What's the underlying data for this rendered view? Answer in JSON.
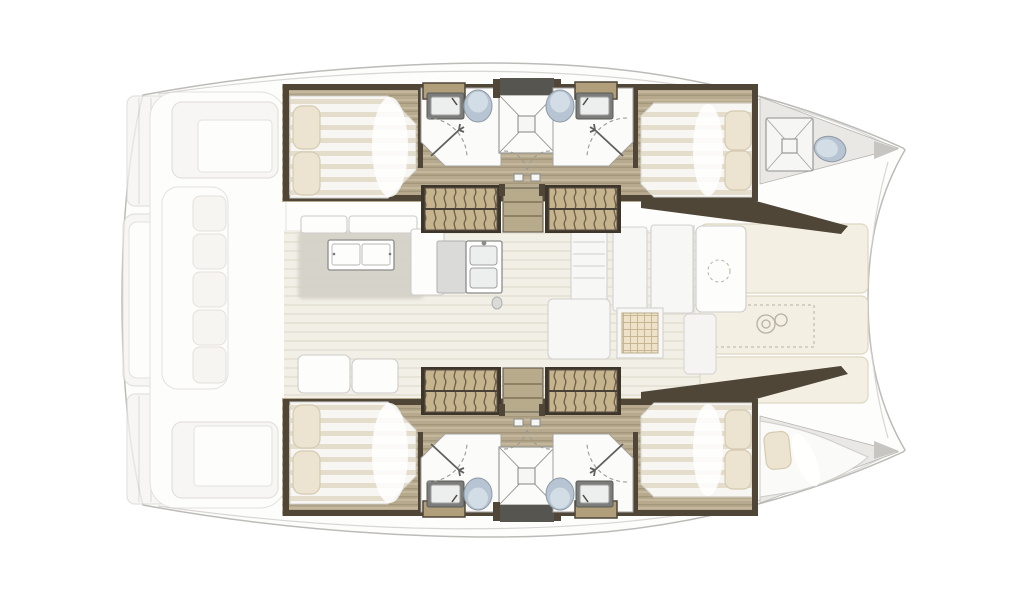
{
  "diagram": {
    "type": "floor-plan",
    "subject": "catamaran-yacht-interior-layout",
    "view": "top-down",
    "orientation": {
      "bow": "right",
      "stern": "left"
    },
    "areas": [
      "stern-swim-platforms",
      "aft-cockpit-with-bench-seating",
      "saloon-with-dining-table-and-galley-sink",
      "port-hull-top: aft-double-cabin, two-bathrooms, central-shower, forward-double-cabin",
      "starboard-hull-bottom: aft-double-cabin, two-bathrooms, central-shower, forward-double-cabin",
      "port-forepeak: storage-crate-and-sea-toilet",
      "starboard-forepeak: skipper-berth",
      "foredeck-sun-pads-with-windlass"
    ],
    "fixtures": [
      "double-berth-with-pillows",
      "washbasin",
      "toilet",
      "shower-enclosure",
      "shower-door-arc",
      "companionway-stairs",
      "stair-landing",
      "wardrobe",
      "deck-hatch",
      "dining-table",
      "saloon-bench",
      "galley-double-sink",
      "stove",
      "refrigerator-cabinet",
      "foredeck-door-with-porthole",
      "windlass",
      "anchor-locker-outline",
      "cockpit-bench-cushions",
      "transom-steps"
    ]
  },
  "palette": {
    "outline": "#bcbbb8",
    "deck_fill": "#fdfdfc",
    "deck_panel": "#f5f4f2",
    "deck_stroke": "#d9d8d5",
    "deck_line": "#d7d6d3",
    "wood_base": "#b6a98d",
    "wood_light": "#c4b79b",
    "wood_dark": "#a4977c",
    "wood_cabinet": "#b19f7c",
    "bulkhead": "#4f4638",
    "stair_frame": "#3e362b",
    "stair_base": "#c6b48f",
    "stair_wave": "#6f624b",
    "stair_mid": "#4a4136",
    "landing": "#b8ab8c",
    "landing_line": "#8d8064",
    "mattress_base": "#f7f6f2",
    "mattress_stripe": "#e4ddcc",
    "mattress_stroke": "#d6d4d0",
    "pillow": "#ece4d1",
    "pillow_stroke": "#d5cab0",
    "bath_floor": "#fbfbfa",
    "bath_stroke": "#a3a29f",
    "toilet_fill": "#b6c4d3",
    "toilet_inner": "#d3dde6",
    "toilet_stroke": "#8f99a3",
    "sink_outer": "#7c7c7a",
    "sink_inner": "#edeeee",
    "shower_line": "#9a9a98",
    "hatch_dark": "#56554f",
    "saloon_base": "#f2efe7",
    "saloon_stripe": "#e5e0d3",
    "rug": "#d4d0c7",
    "white_furn": "#fdfdfc",
    "furn_stroke": "#cdccc9",
    "cushion": "#f5f3ee",
    "cushion_stroke": "#dcd8cf",
    "galley_fill": "#f7f7f5",
    "galley_stroke": "#d2d1ce",
    "table_stroke": "#8b8b89",
    "stove_base": "#eee3ca",
    "stove_grid": "#c8b691",
    "foredeck_panel": "#f3efe2",
    "foredeck_stroke": "#ded7c3",
    "foredeck_icon": "#b7b1a0",
    "forepeak_fill": "#e9e8e5",
    "forepeak_stroke": "#b5b4b1",
    "tip_shade": "#c6c5c2",
    "berth_fill": "#fafaf8"
  }
}
